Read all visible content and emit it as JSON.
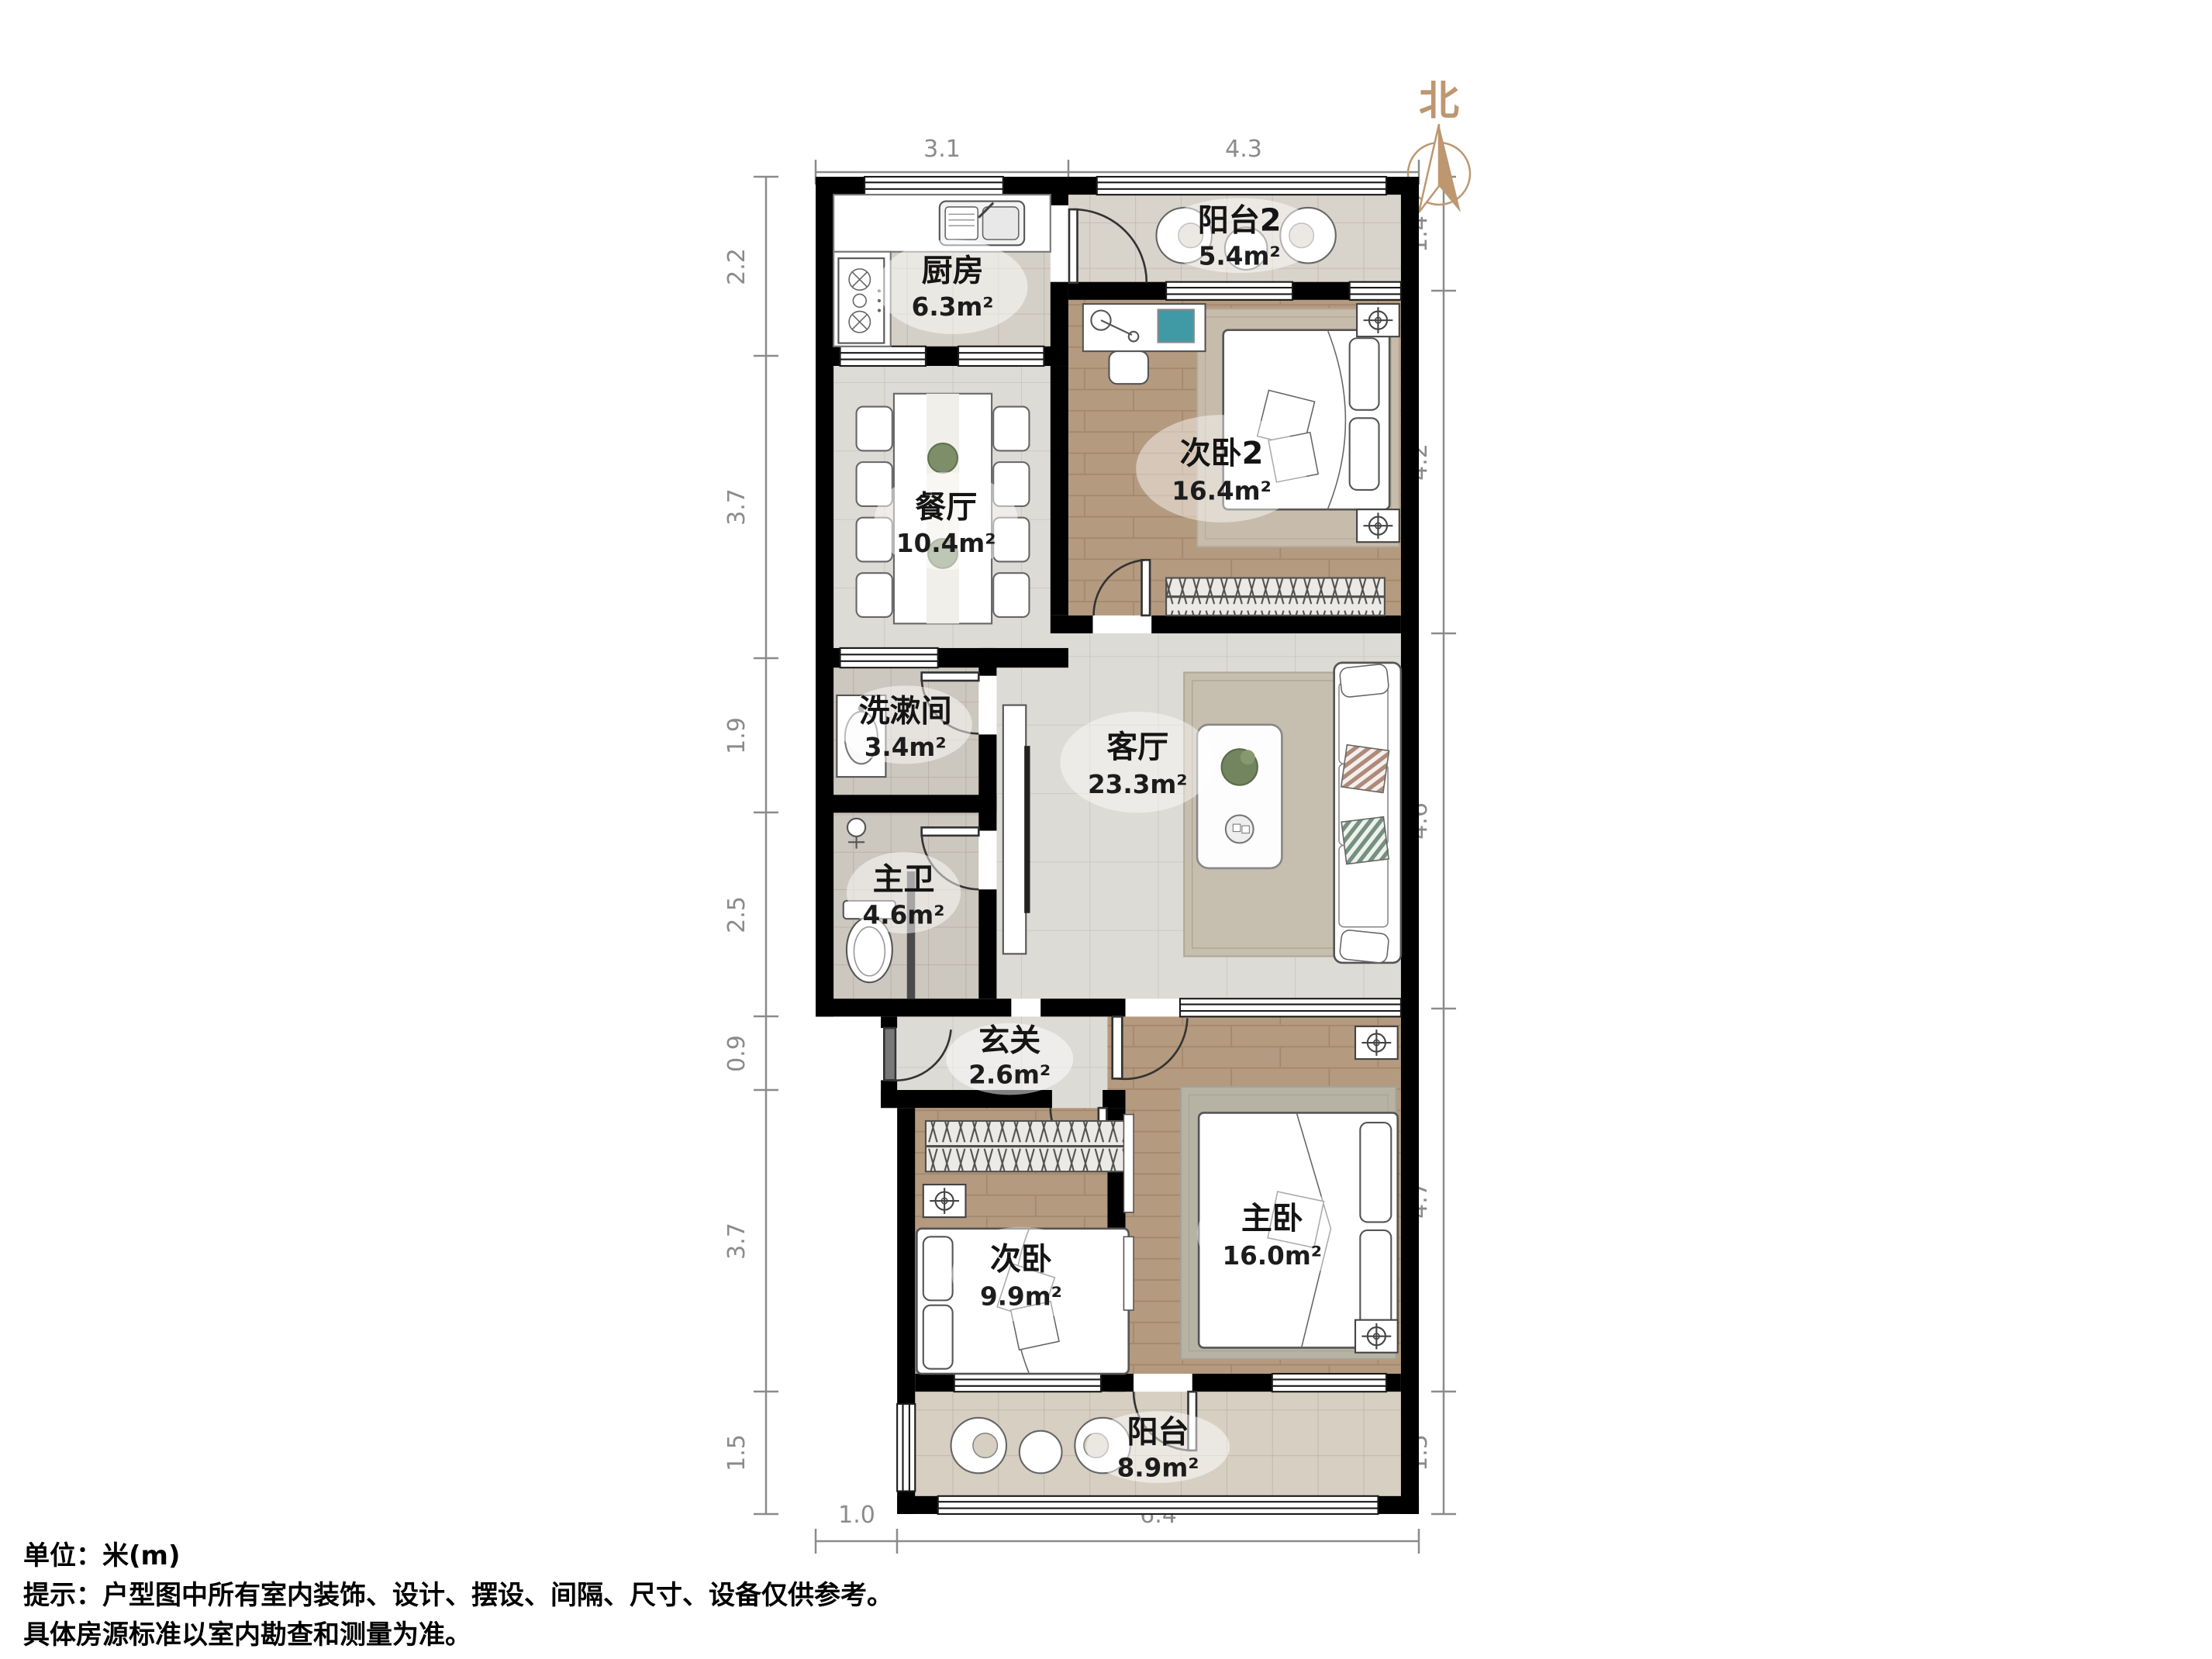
{
  "compass": {
    "label": "北"
  },
  "rooms": {
    "kitchen": {
      "name": "厨房",
      "area": "6.3m²"
    },
    "balcony2": {
      "name": "阳台2",
      "area": "5.4m²"
    },
    "bedroom2": {
      "name": "次卧2",
      "area": "16.4m²"
    },
    "dining": {
      "name": "餐厅",
      "area": "10.4m²"
    },
    "washroom": {
      "name": "洗漱间",
      "area": "3.4m²"
    },
    "living": {
      "name": "客厅",
      "area": "23.3m²"
    },
    "master_bath": {
      "name": "主卫",
      "area": "4.6m²"
    },
    "entry": {
      "name": "玄关",
      "area": "2.6m²"
    },
    "bedroom": {
      "name": "次卧",
      "area": "9.9m²"
    },
    "master_bedroom": {
      "name": "主卧",
      "area": "16.0m²"
    },
    "balcony": {
      "name": "阳台",
      "area": "8.9m²"
    }
  },
  "dimensions": {
    "top": [
      "3.1",
      "4.3"
    ],
    "left": [
      "2.2",
      "3.7",
      "1.9",
      "2.5",
      "0.9",
      "3.7",
      "1.5"
    ],
    "right": [
      "1.4",
      "4.2",
      "4.6",
      "4.7",
      "1.5"
    ],
    "bottom": [
      "1.0",
      "6.4"
    ]
  },
  "footer": {
    "unit": "单位：米(m)",
    "tip": "提示：户型图中所有室内装饰、设计、摆设、间隔、尺寸、设备仅供参考。",
    "note": "具体房源标准以室内勘查和测量为准。"
  },
  "colors": {
    "wall": "#000000",
    "dimension": "#8b8b8b",
    "compass": "#bd9770",
    "wood": "#b49a7f",
    "tile_light": "#dddbd6",
    "tile_warm": "#d6cfc2"
  }
}
